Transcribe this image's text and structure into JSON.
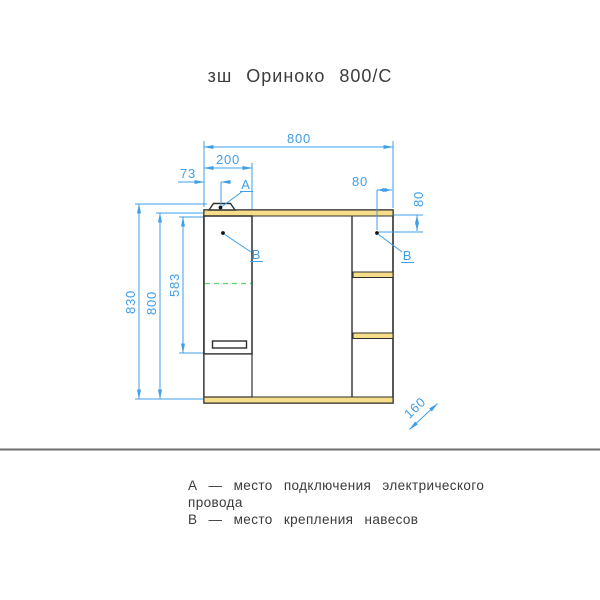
{
  "title": "зш Ориноко 800/С",
  "dimensions": {
    "width_total": "800",
    "door_width": "200",
    "connect_offset_x": "73",
    "hinge_offset_x": "80",
    "hinge_offset_y": "80",
    "height_total": "830",
    "height_body": "800",
    "door_height": "583",
    "depth": "160"
  },
  "markers": {
    "a_label": "А",
    "b_label_left": "В",
    "b_label_right": "В"
  },
  "legend": {
    "lines": [
      "А — место подключения электрического",
      "провода",
      "В — место крепления навесов"
    ]
  },
  "colors": {
    "dimension_blue": "#3f9fe8",
    "outline_dark": "#2f2f2f",
    "panel_edge_yellow": "#f5dd8a",
    "hinge_green": "#5cd66c",
    "separator_gray": "#6e6e6e"
  }
}
